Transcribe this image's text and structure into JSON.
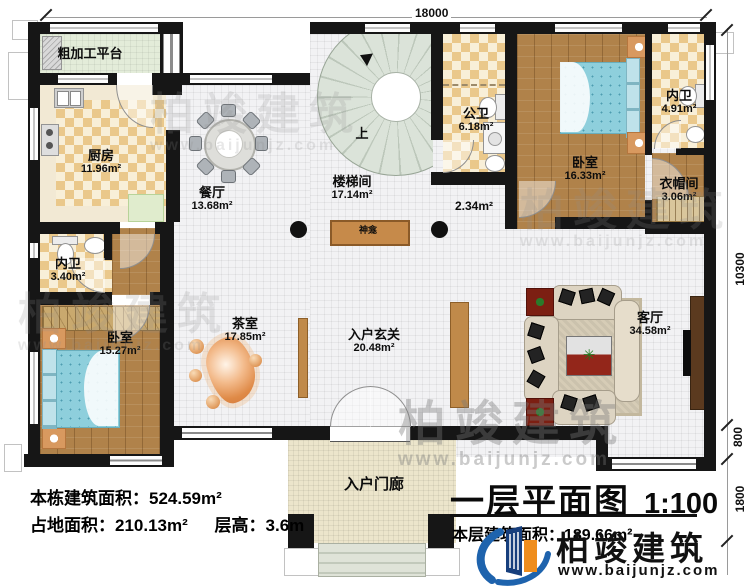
{
  "title": {
    "main": "一层平面图",
    "scale": "1:100",
    "floor_area": "本层建筑面积：189.66m²"
  },
  "info": {
    "line1": "本栋建筑面积：524.59m²",
    "line2_a": "占地面积：210.13m²",
    "line2_b": "层高：3.6m"
  },
  "brand": {
    "name": "柏竣建筑",
    "url": "www.baijunjz.com"
  },
  "watermark": {
    "name": "柏竣建筑",
    "url": "www.baijunjz.com"
  },
  "dims": {
    "top": "18000",
    "right_total": "10300",
    "right_offset": "800",
    "right_porch": "1800"
  },
  "rooms": {
    "rough_platform": {
      "name": "粗加工平台",
      "area": ""
    },
    "kitchen": {
      "name": "厨房",
      "area": "11.96m²"
    },
    "dining": {
      "name": "餐厅",
      "area": "13.68m²"
    },
    "stairwell": {
      "name": "楼梯间",
      "area": "17.14m²"
    },
    "public_bath": {
      "name": "公卫",
      "area": "6.18m²"
    },
    "bedroom_top": {
      "name": "卧室",
      "area": "16.33m²"
    },
    "ensuite_top": {
      "name": "内卫",
      "area": "4.91m²"
    },
    "cloakroom": {
      "name": "衣帽间",
      "area": "3.06m²"
    },
    "ensuite_left": {
      "name": "内卫",
      "area": "3.40m²"
    },
    "bedroom_left": {
      "name": "卧室",
      "area": "15.27m²"
    },
    "tea_room": {
      "name": "茶室",
      "area": "17.85m²"
    },
    "entry_hall": {
      "name": "入户玄关",
      "area": "20.48m²"
    },
    "living": {
      "name": "客厅",
      "area": "34.58m²"
    },
    "porch": {
      "name": "入户门廊",
      "area": ""
    }
  },
  "labels": {
    "small_area": "2.34m²",
    "shrine": "神龛",
    "stair_up": "上"
  },
  "colors": {
    "wall": "#161616",
    "wood": "#b0824a",
    "checker": "#eac88b",
    "accent_brown": "#c08a4a",
    "bed_blue": "#8ecfdc",
    "logo_blue": "#1e63ad",
    "logo_orange": "#ef8d1d"
  }
}
